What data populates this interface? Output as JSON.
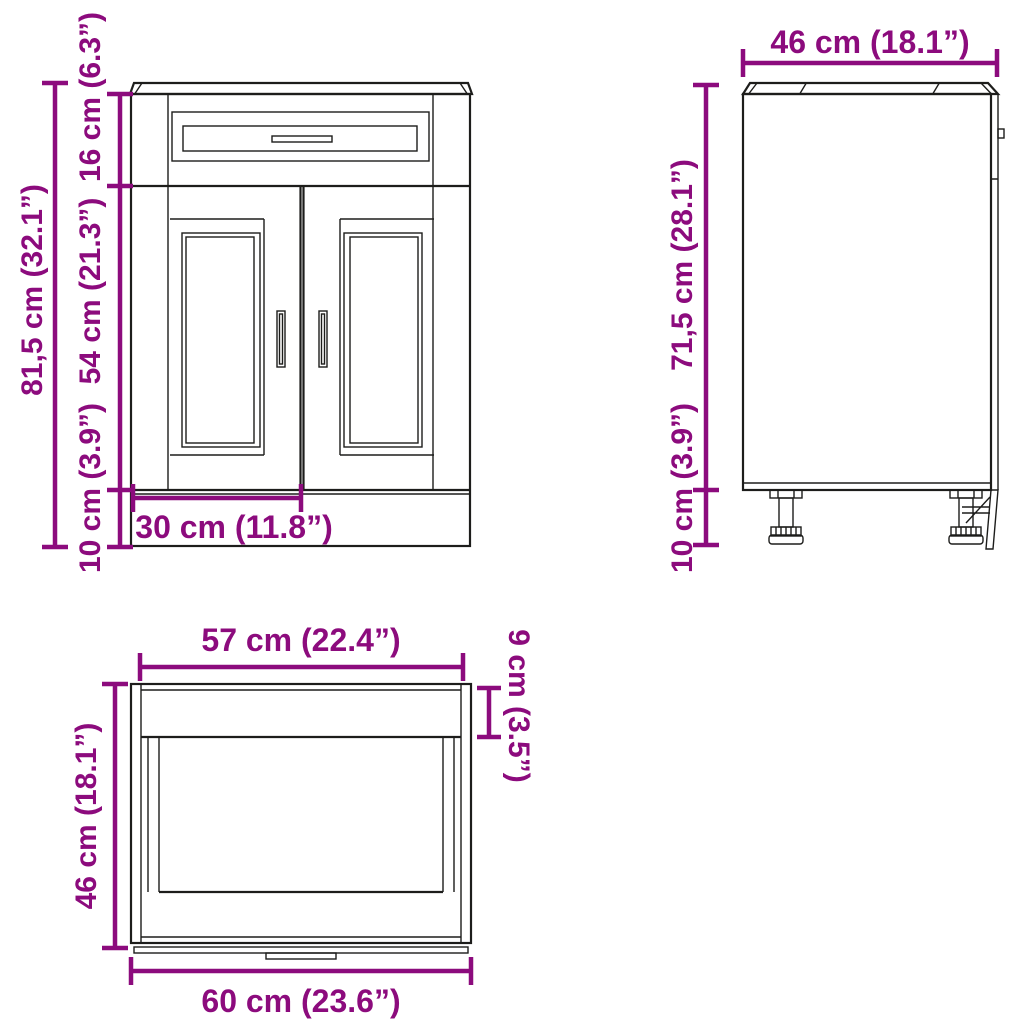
{
  "page": {
    "background": "#ffffff",
    "line_color": "#1d1d1b",
    "accent_color": "#8c0b7d",
    "subject": "kitchen base sink cabinet dimension drawing"
  },
  "views": {
    "front": {
      "name": "front-view",
      "dims": {
        "total_height": "81,5 cm (32.1”)",
        "drawer_height": "16 cm (6.3”)",
        "door_height": "54 cm (21.3”)",
        "plinth_height": "10 cm (3.9”)",
        "door_width": "30 cm (11.8”)"
      }
    },
    "side": {
      "name": "side-view",
      "dims": {
        "depth": "46 cm (18.1”)",
        "body_height": "71,5 cm (28.1”)",
        "feet_height": "10 cm (3.9”)"
      }
    },
    "top": {
      "name": "top-view",
      "dims": {
        "inner_width": "57 cm (22.4”)",
        "front_rail_depth": "9 cm (3.5”)",
        "depth": "46 cm (18.1”)",
        "total_width": "60 cm (23.6”)"
      }
    }
  }
}
